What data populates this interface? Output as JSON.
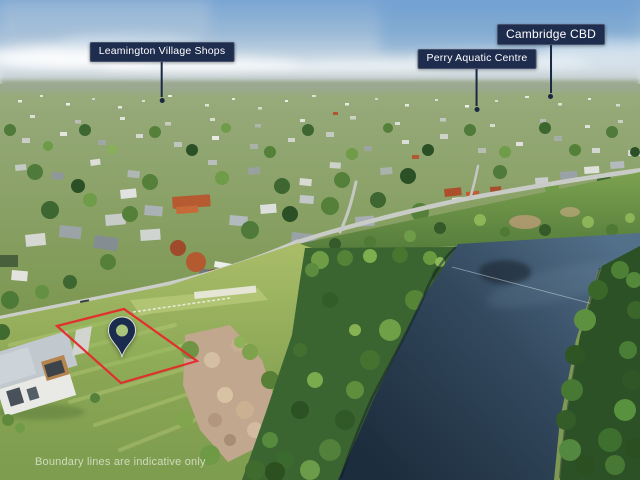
{
  "callouts": [
    {
      "id": "leamington",
      "label": "Leamington Village Shops"
    },
    {
      "id": "perry",
      "label": "Perry Aquatic Centre"
    },
    {
      "id": "cambridge",
      "label": "Cambridge CBD"
    }
  ],
  "marker": {
    "icon": "location-pin-icon",
    "pin_color": "#1b2b4e",
    "pin_hole_color": "#a9c57c"
  },
  "boundary": {
    "color": "#e5292b"
  },
  "callout_style": {
    "bg": "#1e2c4e",
    "text": "#ffffff",
    "line": "#1a2843"
  },
  "disclaimer": "Boundary lines are indicative only",
  "scene_colors": {
    "sky": "#79a5d3",
    "water": "#22374a",
    "grass": "#8aa655"
  }
}
